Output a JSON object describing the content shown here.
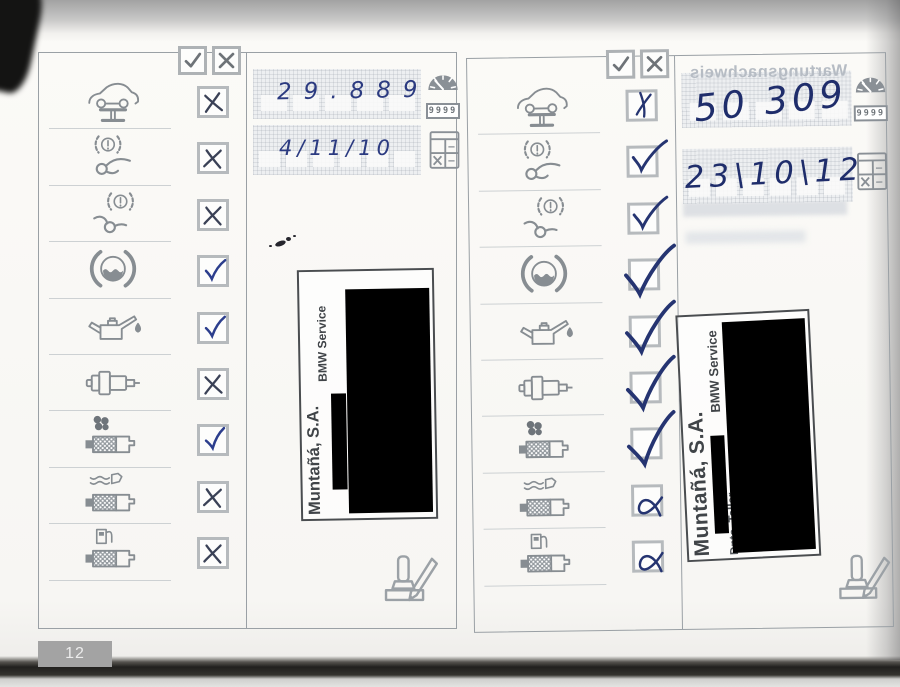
{
  "page_number": "12",
  "legend": {
    "check_symbol": "✓",
    "cross_symbol": "✗"
  },
  "service_items": [
    {
      "id": "car-lift",
      "label": "vehicle-on-lift"
    },
    {
      "id": "brake-front",
      "label": "front-brakes"
    },
    {
      "id": "brake-rear",
      "label": "rear-brakes"
    },
    {
      "id": "brake-fluid",
      "label": "brake-fluid"
    },
    {
      "id": "engine-oil",
      "label": "engine-oil"
    },
    {
      "id": "spark-plug",
      "label": "spark-plugs"
    },
    {
      "id": "air-filter",
      "label": "air-filter"
    },
    {
      "id": "engine-filter",
      "label": "engine-filter"
    },
    {
      "id": "fuel-filter",
      "label": "fuel-filter"
    }
  ],
  "left_record": {
    "mileage": "29.889",
    "date": "4/11/10",
    "marks": [
      "x",
      "x",
      "x",
      "check",
      "check",
      "x",
      "check",
      "x",
      "x"
    ],
    "stamp": {
      "company": "Muntañá, S.A.",
      "brand": "BMW Service"
    }
  },
  "right_record": {
    "mileage": "50 309",
    "date": "23\\10\\12",
    "marks": [
      "x-cursive",
      "check-med",
      "check-med",
      "check-large",
      "check-large",
      "check-large",
      "check-large",
      "x-alpha",
      "x-alpha"
    ],
    "stamp": {
      "company": "Muntañá, S.A.",
      "brand": "BMW Service",
      "dept": "Dpto. Taller"
    }
  },
  "odometer_icon_digits": "9999",
  "bleed_through_text": "Wartungsnachweis",
  "colors": {
    "ink_blue": "#2c3e8d",
    "ink_dark": "#3a4156",
    "ink_right": "#253471",
    "icon_gray": "#878d92",
    "stamp_ink": "#404448",
    "redaction": "#000000"
  }
}
